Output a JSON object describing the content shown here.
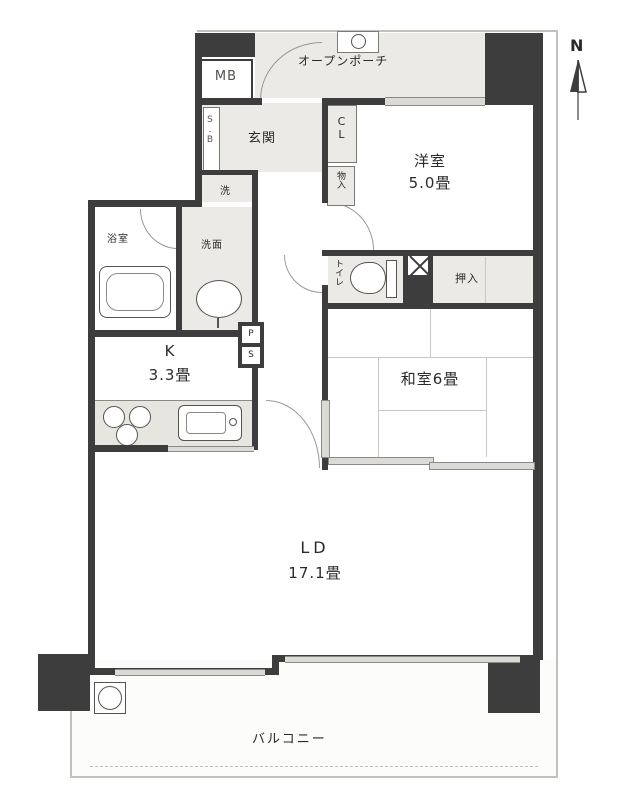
{
  "compass": {
    "north": "N"
  },
  "rooms": {
    "porch": {
      "label": "オープンポーチ"
    },
    "mb": {
      "label": "MB"
    },
    "genkan": {
      "label": "玄関"
    },
    "sb": {
      "label": "S.B"
    },
    "cl": {
      "label": "CL"
    },
    "monoire": {
      "label": "物入"
    },
    "western": {
      "name": "洋室",
      "size": "5.0畳"
    },
    "laundry": {
      "label": "洗"
    },
    "washroom": {
      "label": "洗面"
    },
    "bath": {
      "label": "浴室"
    },
    "toilet": {
      "label": "トイレ"
    },
    "ps": {
      "top": "P",
      "bottom": "S"
    },
    "oshiire": {
      "label": "押入"
    },
    "japanese": {
      "label": "和室6畳"
    },
    "kitchen": {
      "name": "K",
      "size": "3.3畳"
    },
    "living": {
      "name": "LD",
      "size": "17.1畳"
    },
    "balcony": {
      "label": "バルコニー"
    }
  },
  "colors": {
    "wall": "#3d3d3d",
    "texture": "#eceae6",
    "outline": "#c3c1bc"
  }
}
